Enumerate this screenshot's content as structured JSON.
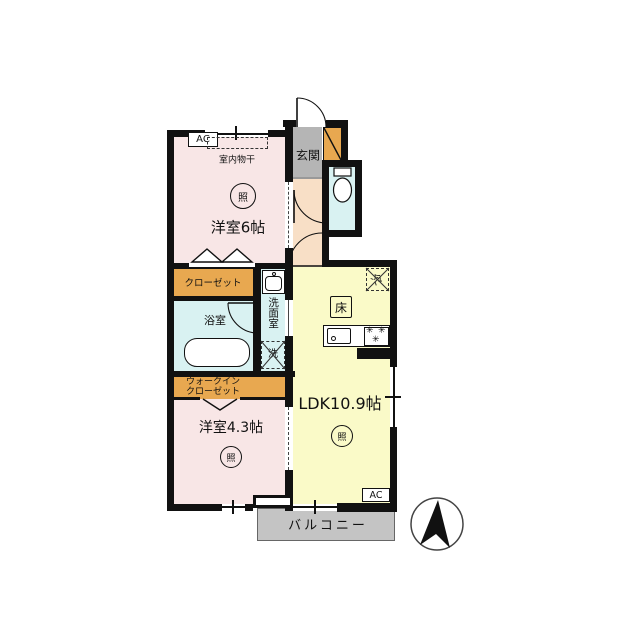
{
  "plan": {
    "rooms": {
      "western6": "洋室6帖",
      "entrance": "玄関",
      "closet": "クローゼット",
      "bath": "浴室",
      "washroom": "洗面室",
      "wic_line1": "ウォークイン",
      "wic_line2": "クローゼット",
      "western43": "洋室4.3帖",
      "ldk": "LDK10.9帖",
      "balcony": "バルコニー"
    },
    "labels": {
      "ac": "AC",
      "indoor_drying": "室内物干",
      "light": "照",
      "floor_storage": "床",
      "fridge": "冷",
      "laundry": "洗",
      "burner": "✳"
    },
    "colors": {
      "wall": "#111111",
      "room_pink": "#f8e6e6",
      "ldk_yellow": "#fafac8",
      "closet_orange": "#e8a850",
      "wet_cyan": "#d9f2f2",
      "entrance_gray": "#b5b5b5",
      "hall_peach": "#f8dfc6",
      "balcony_gray": "#c4c4c4"
    }
  }
}
